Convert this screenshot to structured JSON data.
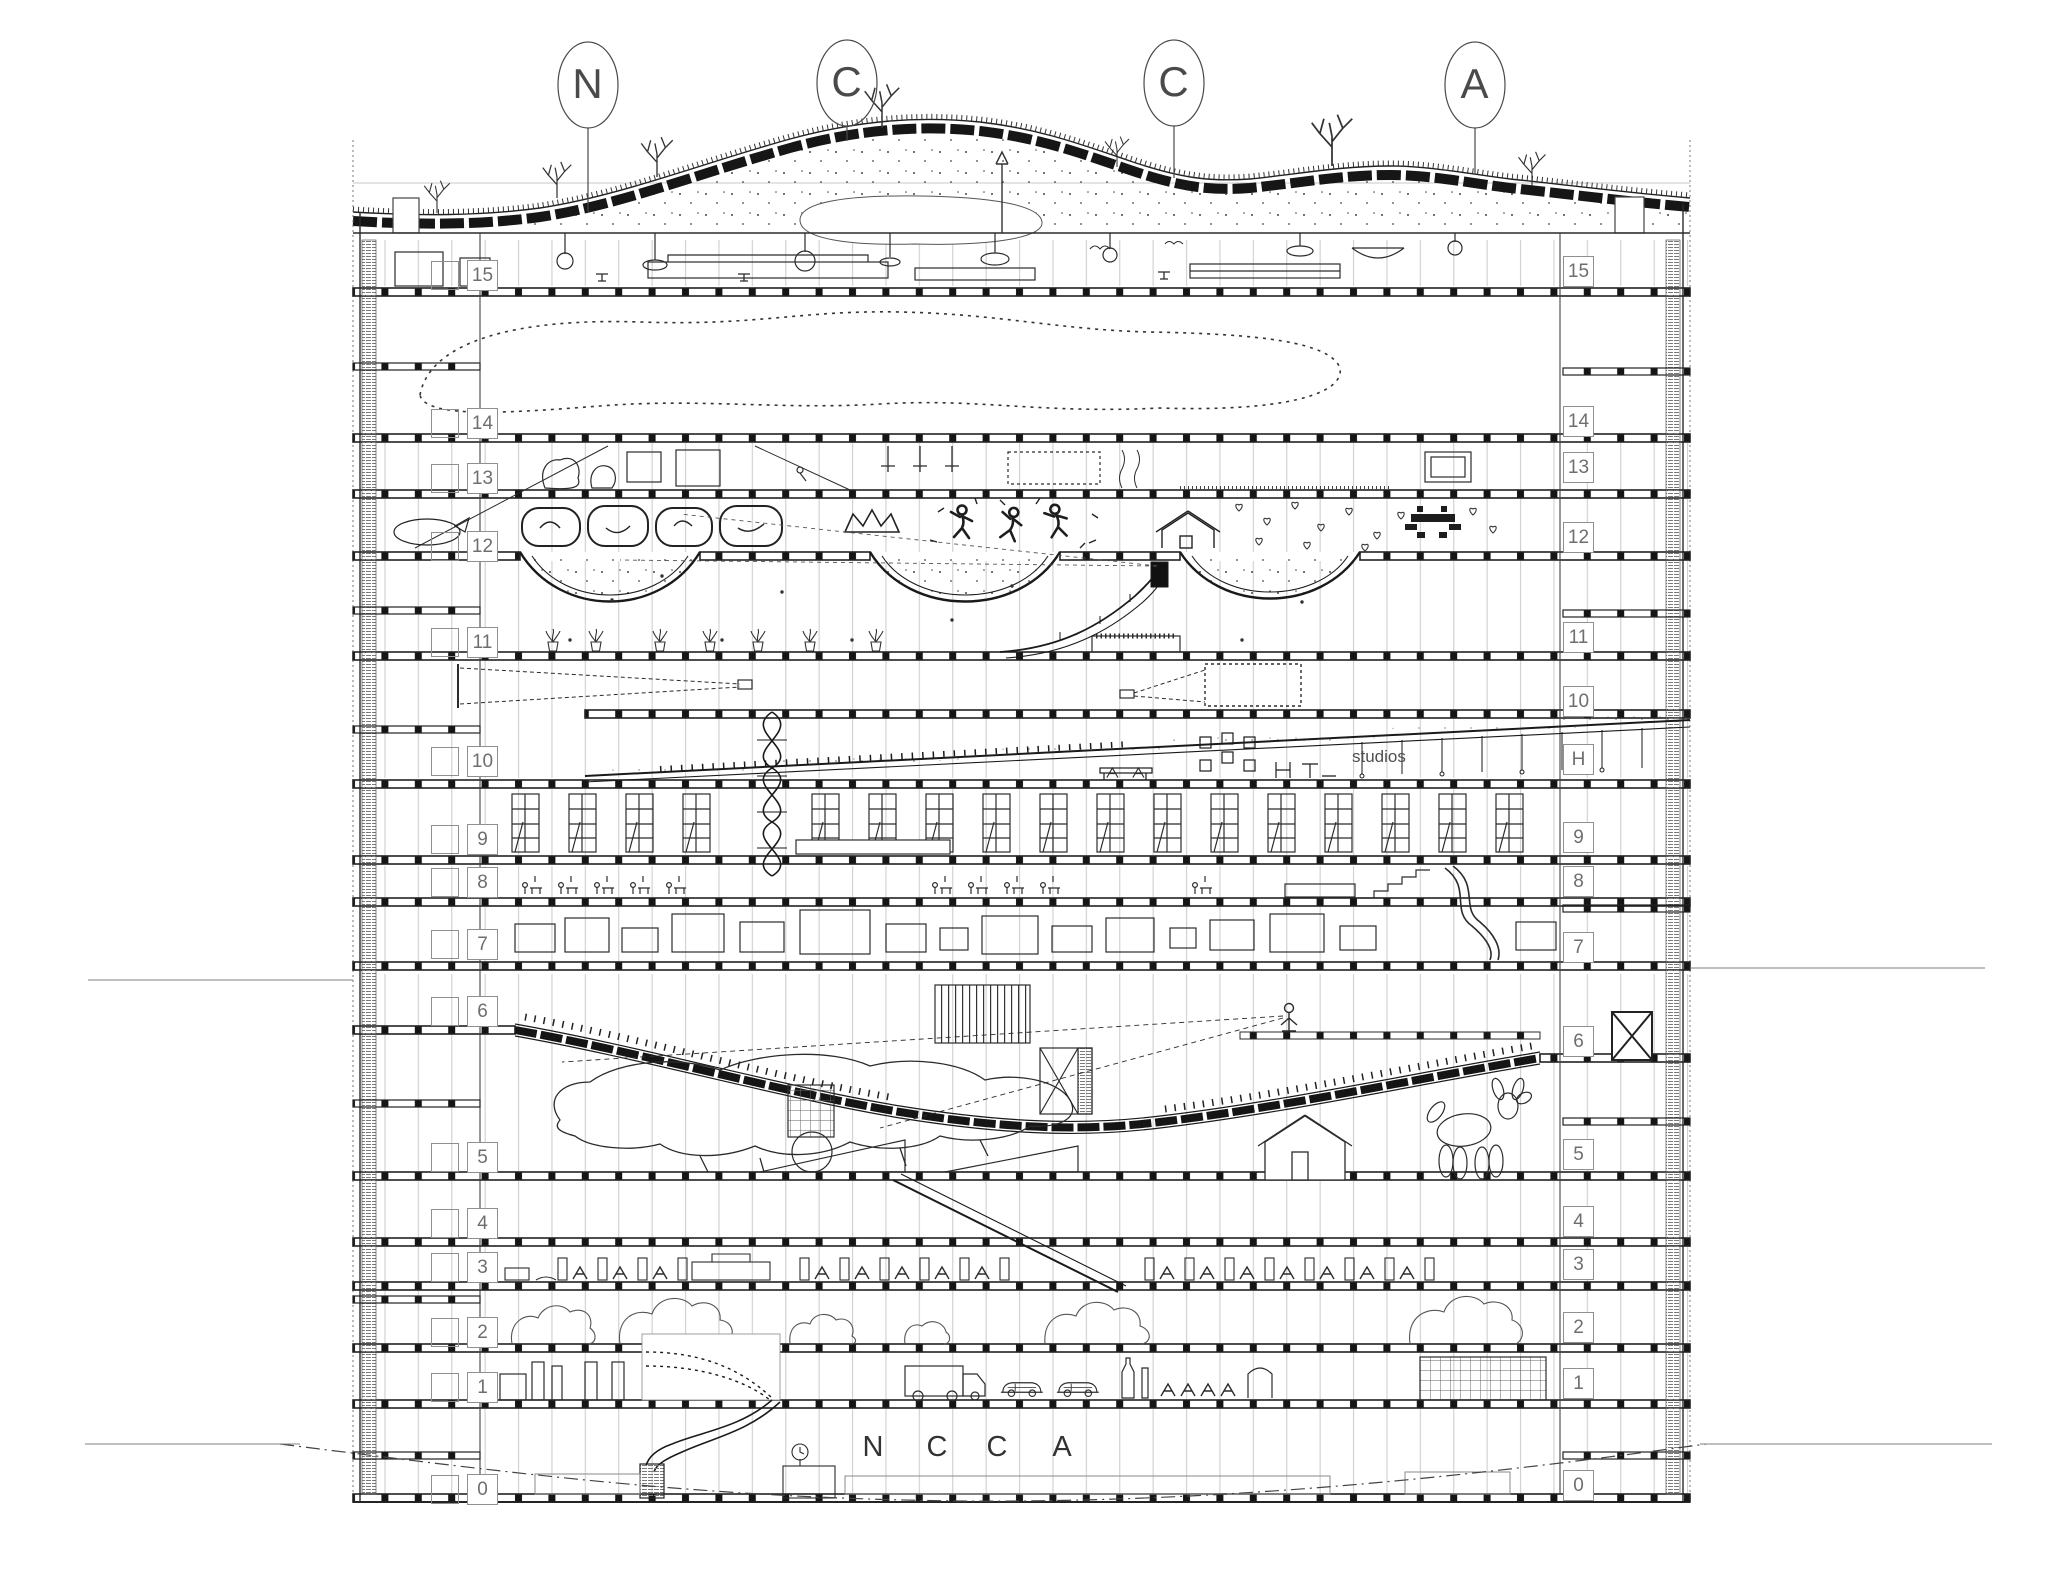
{
  "title": "NCCA building section drawing",
  "colors": {
    "ink": "#2b2b2b",
    "light_line": "#c9c9c9",
    "label_gray": "#6e6e6e",
    "background": "#ffffff"
  },
  "grid_bubbles": [
    "N",
    "C",
    "C",
    "A"
  ],
  "lobby_sign": [
    "N",
    "C",
    "C",
    "A"
  ],
  "floor_labels_left": [
    "15",
    "14",
    "13",
    "12",
    "11",
    "10",
    "9",
    "8",
    "7",
    "6",
    "5",
    "4",
    "3",
    "2",
    "1",
    "0"
  ],
  "floor_labels_right": [
    "15",
    "14",
    "13",
    "12",
    "11",
    "10",
    "H",
    "9",
    "8",
    "7",
    "6",
    "5",
    "4",
    "3",
    "2",
    "1",
    "0"
  ],
  "annotations": {
    "studios": "studios"
  }
}
